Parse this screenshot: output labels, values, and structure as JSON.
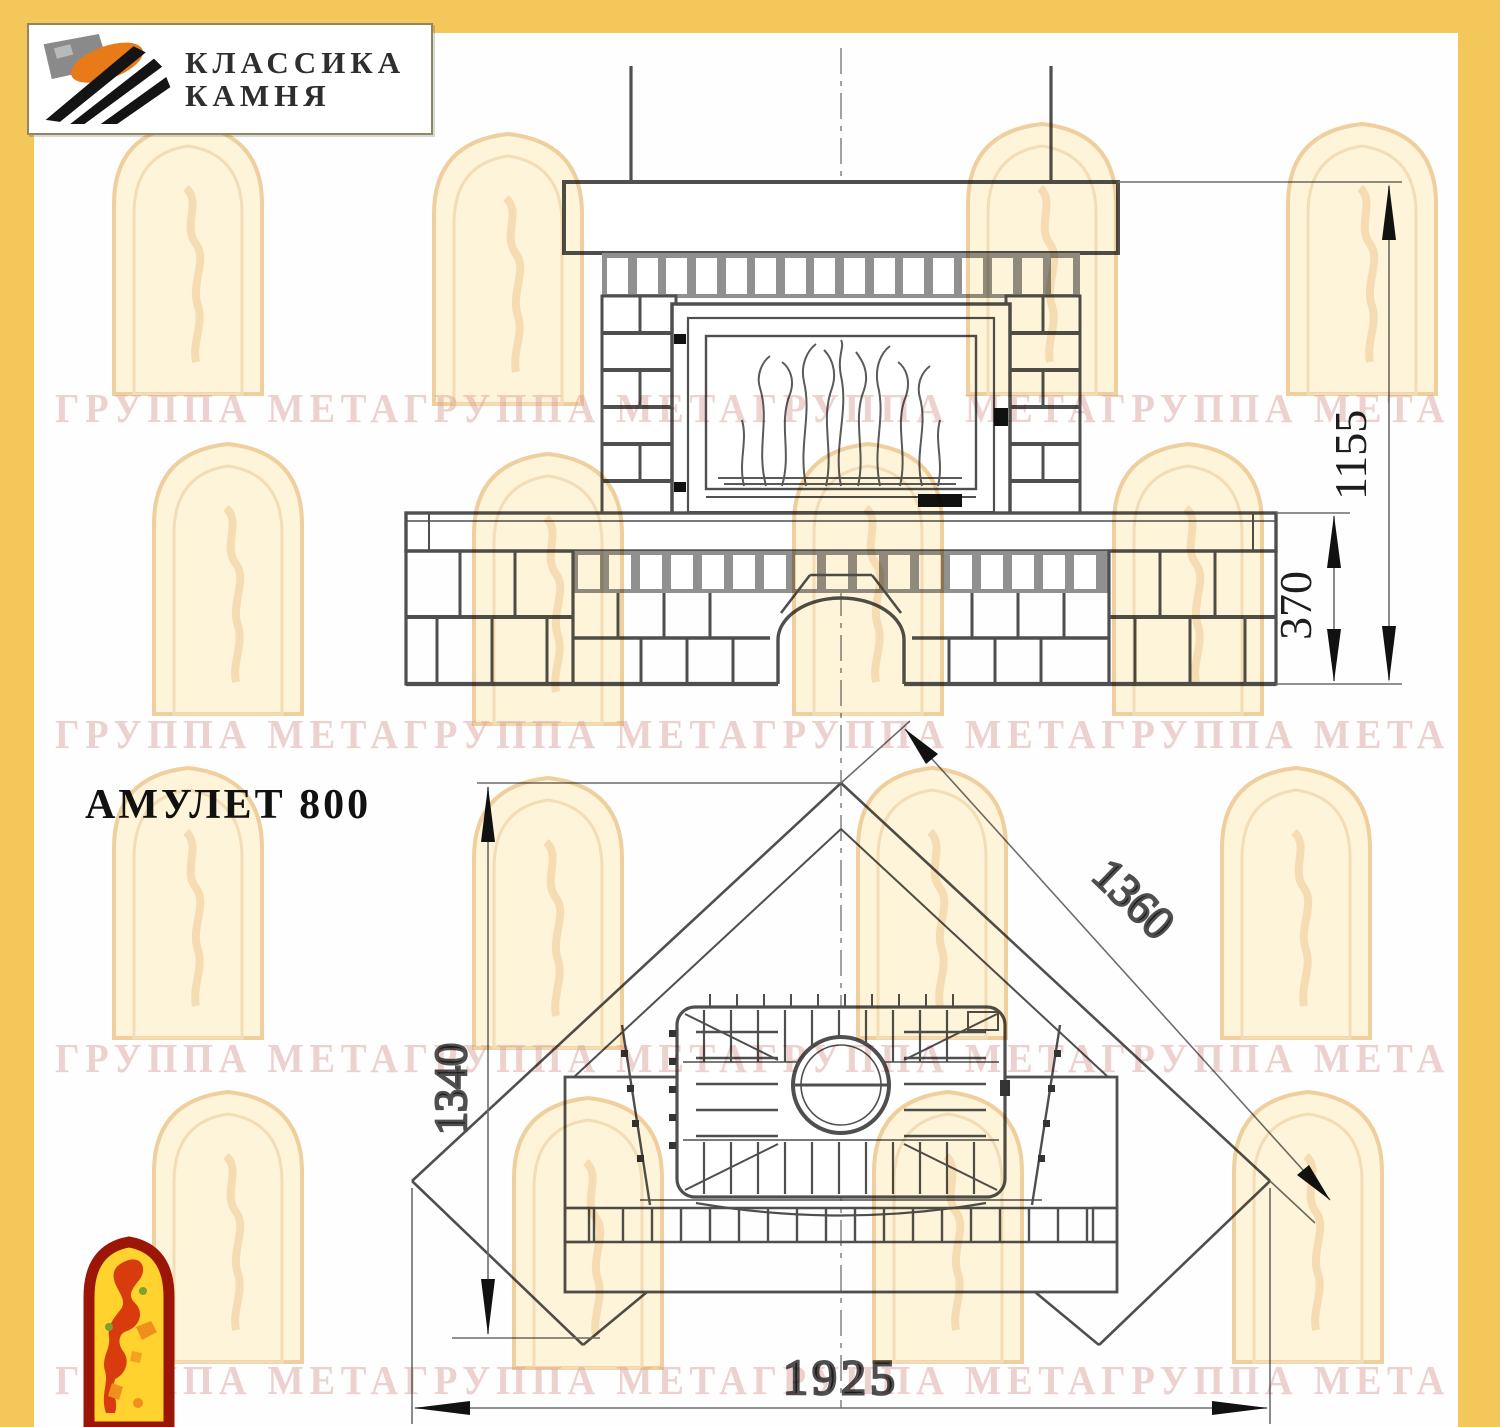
{
  "header": {
    "logo_line1": "КЛАССИКА",
    "logo_line2": "КАМНЯ"
  },
  "title": "АМУЛЕТ 800",
  "watermark_text": "ГРУППА МЕТАГРУППА МЕТАГРУППА МЕТАГРУППА МЕТА",
  "dimensions": {
    "front_height": "1155",
    "front_bench_height": "370",
    "plan_depth": "1340",
    "plan_side": "1360",
    "plan_width": "1925"
  },
  "colors": {
    "border_yellow": "#F4C75B",
    "drawing_line": "#4f4f4f",
    "watermark_pink": "#d89c94",
    "watermark_orange": "#edc9a0",
    "emblem_red": "#9b1606",
    "emblem_yellow": "#ffd22e",
    "logo_orange": "#e87a18",
    "logo_gray": "#8a8a8a"
  }
}
